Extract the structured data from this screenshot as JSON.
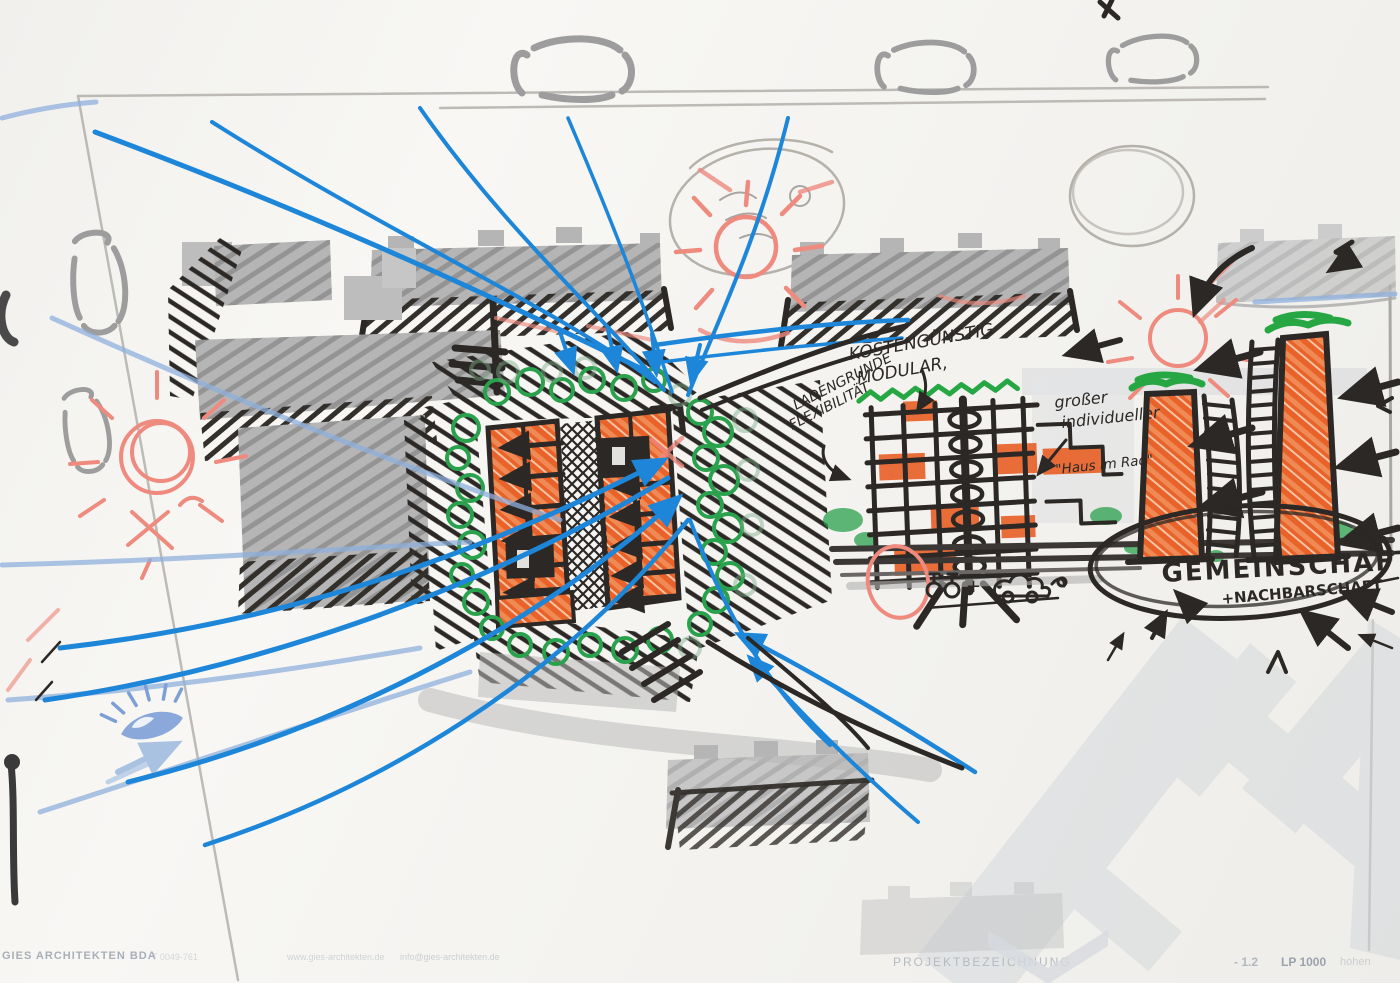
{
  "annotations": {
    "cost_note_line1": "KOSTENGÜNSTIG",
    "cost_note_line2": "MODULAR,",
    "shop_note_line1": "LADENGRUNDE",
    "shop_note_line2": "FLEXIBILITÄT",
    "individual_note_line1": "großer",
    "individual_note_line2": "individueller",
    "individual_quote": "\"Haus im Rad\"",
    "community_label": "GEMEINSCHAFT",
    "neighborhood_label": "+NACHBARSCHAFT",
    "mobility_plus": "+"
  },
  "title_block": {
    "firm": "GIES ARCHITEKTEN BDA",
    "phone": "T 0049-761",
    "website": "www.gies-architekten.de",
    "email": "info@gies-architekten.de",
    "project_label": "PROJEKTBEZEICHNUNG",
    "sheet_number": "- 1.2",
    "phase": "LP 1000",
    "phase_suffix": "hohen"
  },
  "icons": {
    "sun": "sun-icon",
    "eye": "eye-icon",
    "bicycle": "bicycle-icon",
    "car": "car-icon",
    "tree": "tree-icon",
    "spiral": "spiral-stair-icon"
  },
  "palette": {
    "orange": "#e8622a",
    "green": "#27a744",
    "blue": "#1d86d8",
    "light_blue": "#8fb0dd",
    "salmon": "#ee8a7e",
    "ink": "#2b2825",
    "gray": "#a9a9a9",
    "pencil": "#b5b1ab"
  }
}
